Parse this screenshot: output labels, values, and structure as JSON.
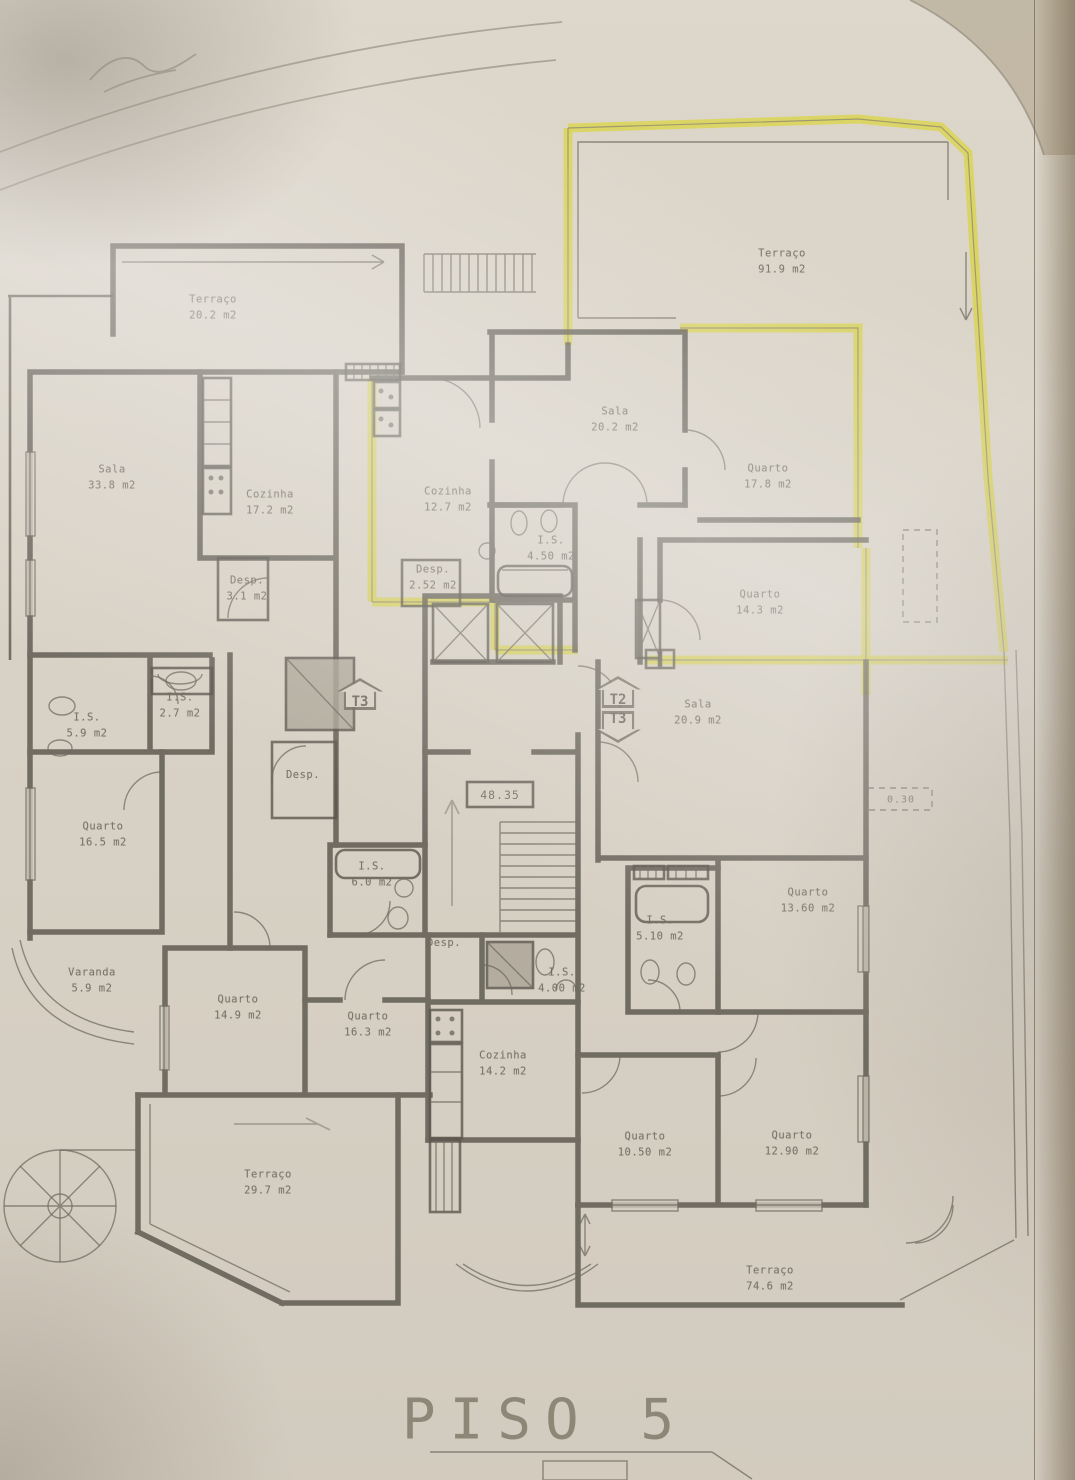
{
  "title": "PISO 5",
  "colors": {
    "paper": "#e9e3d8",
    "wall": "#55524b",
    "highlight": "#e6e255",
    "label": "#6f6b62"
  },
  "plan": {
    "elevation_label": "48.35",
    "step_label": "0.30",
    "unit_badges": [
      {
        "label": "T3",
        "direction": "up",
        "x": 360,
        "y": 694
      },
      {
        "label": "T2",
        "direction": "up",
        "x": 618,
        "y": 692
      },
      {
        "label": "T3",
        "direction": "down",
        "x": 618,
        "y": 727
      }
    ],
    "rooms": [
      {
        "name": "Terraço",
        "area": "20.2 m2",
        "x": 213,
        "y": 308
      },
      {
        "name": "Terraço",
        "area": "91.9 m2",
        "x": 782,
        "y": 262
      },
      {
        "name": "Sala",
        "area": "20.2 m2",
        "x": 615,
        "y": 420
      },
      {
        "name": "Quarto",
        "area": "17.8 m2",
        "x": 768,
        "y": 477
      },
      {
        "name": "Sala",
        "area": "33.8 m2",
        "x": 112,
        "y": 478
      },
      {
        "name": "Cozinha",
        "area": "17.2 m2",
        "x": 270,
        "y": 503
      },
      {
        "name": "Cozinha",
        "area": "12.7 m2",
        "x": 448,
        "y": 500
      },
      {
        "name": "Desp.",
        "area": "2.52 m2",
        "x": 433,
        "y": 578
      },
      {
        "name": "I.S.",
        "area": "4.50 m2",
        "x": 551,
        "y": 549
      },
      {
        "name": "Desp.",
        "area": "3.1 m2",
        "x": 247,
        "y": 589
      },
      {
        "name": "Quarto",
        "area": "14.3 m2",
        "x": 760,
        "y": 603
      },
      {
        "name": "I.S.",
        "area": "2.7 m2",
        "x": 180,
        "y": 706
      },
      {
        "name": "I.S.",
        "area": "5.9 m2",
        "x": 87,
        "y": 726
      },
      {
        "name": "Sala",
        "area": "20.9 m2",
        "x": 698,
        "y": 713
      },
      {
        "name": "Desp.",
        "area": "",
        "x": 303,
        "y": 775
      },
      {
        "name": "Quarto",
        "area": "16.5 m2",
        "x": 103,
        "y": 835
      },
      {
        "name": "I.S.",
        "area": "6.0 m2",
        "x": 372,
        "y": 875
      },
      {
        "name": "Quarto",
        "area": "13.60 m2",
        "x": 808,
        "y": 901
      },
      {
        "name": "I.S.",
        "area": "5.10 m2",
        "x": 660,
        "y": 929
      },
      {
        "name": "Desp.",
        "area": "",
        "x": 444,
        "y": 943
      },
      {
        "name": "I.S.",
        "area": "4.00 m2",
        "x": 562,
        "y": 981
      },
      {
        "name": "Varanda",
        "area": "5.9 m2",
        "x": 92,
        "y": 981
      },
      {
        "name": "Quarto",
        "area": "14.9 m2",
        "x": 238,
        "y": 1008
      },
      {
        "name": "Quarto",
        "area": "16.3 m2",
        "x": 368,
        "y": 1025
      },
      {
        "name": "Cozinha",
        "area": "14.2 m2",
        "x": 503,
        "y": 1064
      },
      {
        "name": "Quarto",
        "area": "10.50 m2",
        "x": 645,
        "y": 1145
      },
      {
        "name": "Quarto",
        "area": "12.90 m2",
        "x": 792,
        "y": 1144
      },
      {
        "name": "Terraço",
        "area": "29.7 m2",
        "x": 268,
        "y": 1183
      },
      {
        "name": "Terraço",
        "area": "74.6 m2",
        "x": 770,
        "y": 1279
      }
    ]
  }
}
